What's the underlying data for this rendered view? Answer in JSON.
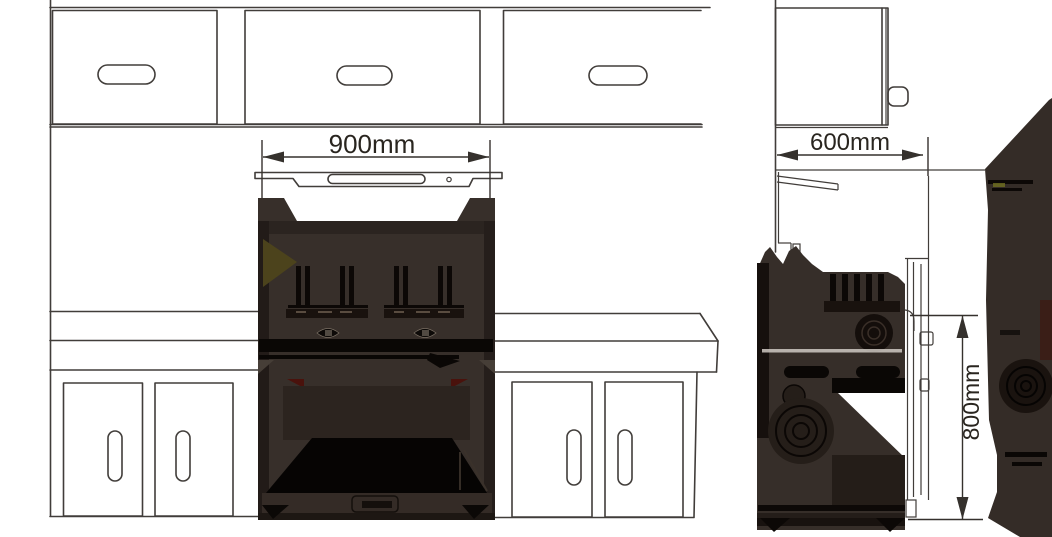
{
  "diagram": {
    "kind": "range cooker installation drawing",
    "views": [
      {
        "id": "front",
        "dimension": "width"
      },
      {
        "id": "side",
        "dimensions": [
          "depth",
          "height"
        ]
      }
    ]
  },
  "labels": {
    "width": "900mm",
    "depth": "600mm",
    "height": "800mm"
  },
  "colors": {
    "background": "#ffffff",
    "line_art": "#413d3a",
    "cooker_body": "#372f2a",
    "cooker_black": "#0a0705",
    "accent_olive": "#4c431c",
    "accent_maroon": "#4a120c"
  }
}
